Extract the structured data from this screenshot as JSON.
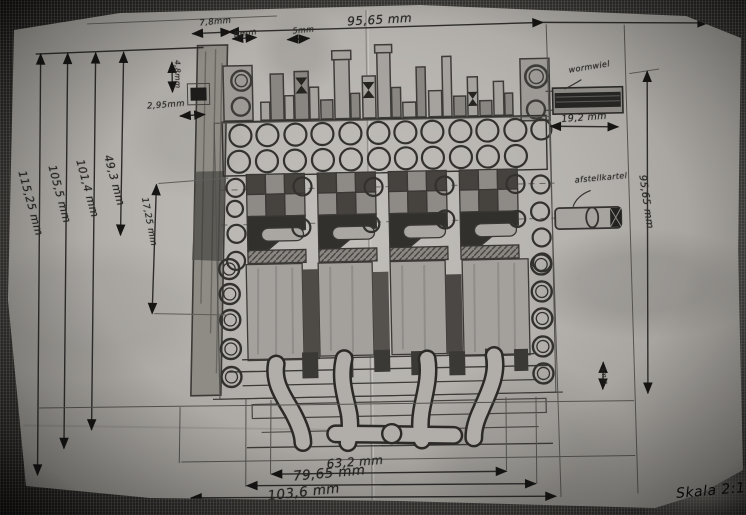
{
  "figure": {
    "label": "Fig.3",
    "scale": "Skala 2:1"
  },
  "dimensions": {
    "top_width": "95,65 mm",
    "top_left_width": "7,8mm",
    "top_left_offset": "8mm",
    "top_pin": "5mm",
    "left_key_height": "4,8mm",
    "left_key_width": "2,95mm",
    "overall_height": "115,25 mm",
    "height_2": "105,5 mm",
    "height_3": "101,4 mm",
    "height_4": "49,3 mm",
    "plank_section": "17,25 mm",
    "worm_width": "19,2 mm",
    "right_height": "95,65 mm",
    "right_small": "3mm",
    "bottom_inner": "63,2 mm",
    "bottom_mid": "79,65 mm",
    "bottom_outer": "103,6 mm"
  },
  "part_labels": {
    "worm_wheel": "wormwiel",
    "adjust_knurl": "afstellkartel"
  }
}
